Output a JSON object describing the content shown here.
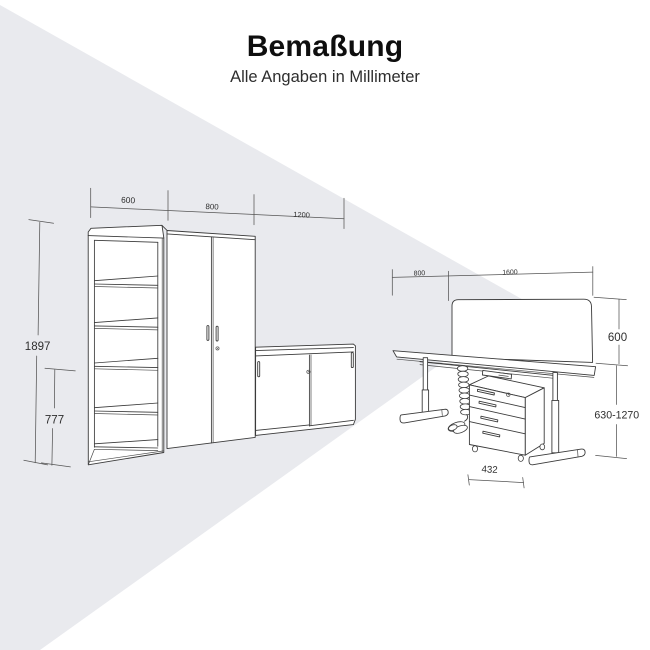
{
  "header": {
    "title": "Bemaßung",
    "subtitle": "Alle Angaben in Millimeter"
  },
  "colors": {
    "wedge": "#e9eaee",
    "line": "#3b3b3b",
    "dim_text": "#2e2e2e"
  },
  "diagram": {
    "cabinet_group": {
      "shelf_width_label": "600",
      "wardrobe_width_label": "800",
      "sideboard_width_label": "1200",
      "total_height_label": "1897",
      "sideboard_height_label": "777"
    },
    "desk_group": {
      "depth_label": "800",
      "width_label": "1600",
      "screen_height_label": "600",
      "desk_height_range_label": "630-1270",
      "pedestal_width_label": "432"
    }
  }
}
